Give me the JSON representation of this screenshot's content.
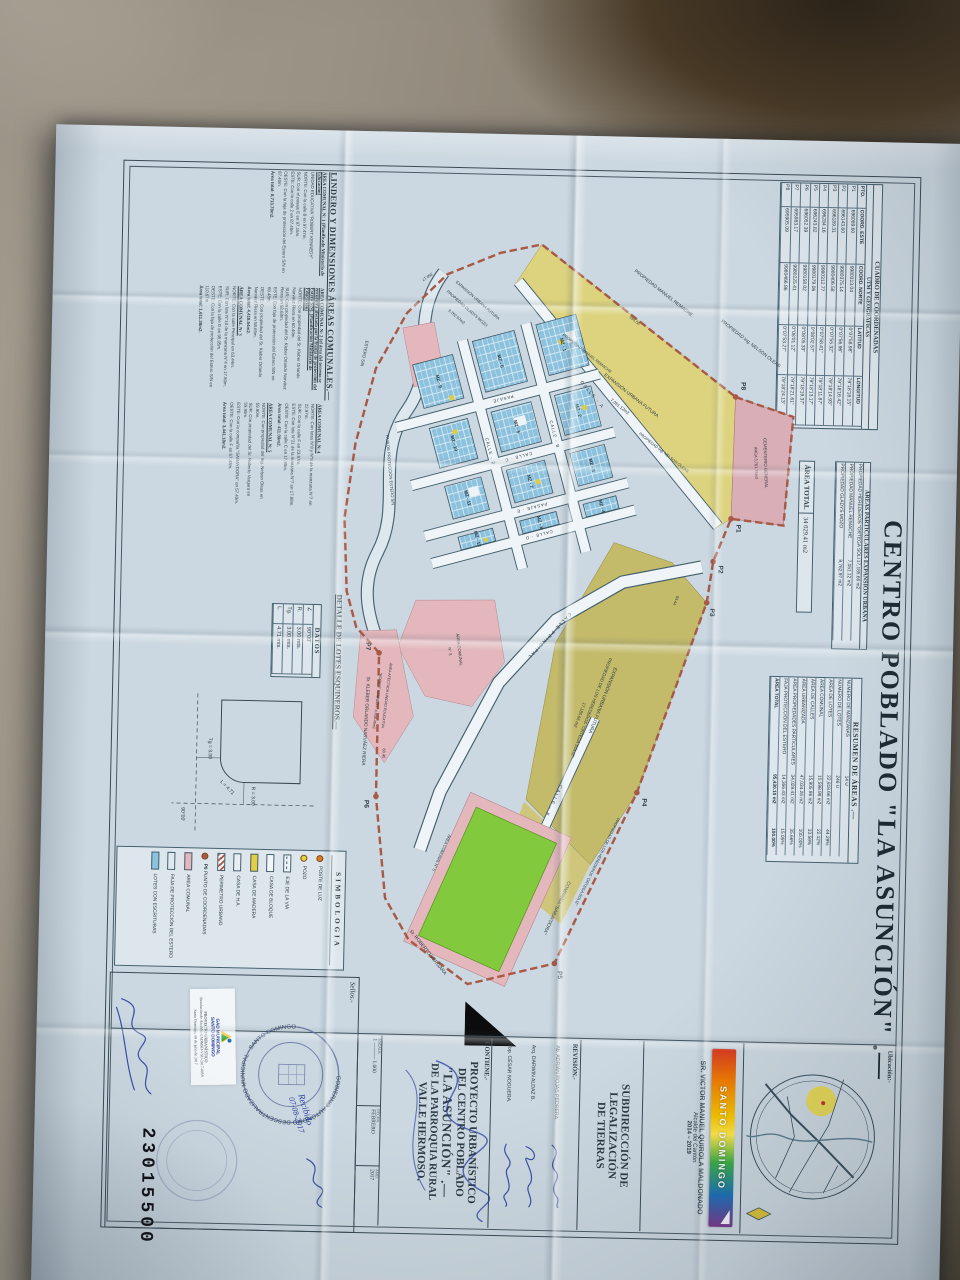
{
  "title": "CENTRO POBLADO \"LA ASUNCIÓN\" .—",
  "sheet_number": "23015500",
  "coord_table": {
    "title_line1": "CUADRO DE COORDENADAS",
    "title_line2": "UTM Y GEOGRÁFICAS",
    "headers": [
      "PTO.",
      "COORD. ESTE",
      "COORD. NORTE",
      "LATITUD",
      "LONGITUD"
    ],
    "rows": [
      [
        "P1",
        "696089.60",
        "9980313.04",
        "0°07'58.98\"",
        "79°18'18.15\""
      ],
      [
        "P2",
        "696143.60",
        "9980375.14",
        "0°07'56.96\"",
        "79°18'16.42\""
      ],
      [
        "P3",
        "696189.31",
        "9980406.58",
        "0°07'55.32\"",
        "79°18'14.93\""
      ],
      [
        "P4",
        "696284.16",
        "9980312.77",
        "0°07'58.41\"",
        "79°18'11.87\""
      ],
      [
        "P5",
        "696243.82",
        "9980179.06",
        "0°08'02.57\"",
        "79°18'13.17\""
      ],
      [
        "P6",
        "696052.39",
        "9980158.02",
        "0°08'05.33\"",
        "79°18'19.37\""
      ],
      [
        "P7",
        "695983.17",
        "9980225.41",
        "0°08'01.12\"",
        "79°18'21.61\""
      ],
      [
        "P8",
        "695905.09",
        "9980466.86",
        "0°07'53.27\"",
        "79°18'24.13\""
      ]
    ]
  },
  "areas_particulares": {
    "title": "ÁREAS PARTICULARES EXPANSIÓN URBANA",
    "rows": [
      {
        "label": "PROPIEDAD HEREDEROS \"ORTEGA SOLIZ\"",
        "value": "17,185.66 m2"
      },
      {
        "label": "PROPIEDAD MANUEL REMACHE",
        "value": "7,051.12 m2"
      },
      {
        "label": "PROPIEDAD GLADYS MOZO",
        "value": "9,762.97 m2"
      }
    ]
  },
  "area_total": {
    "label": "ÁREA TOTAL",
    "value": "34 029.41 m2"
  },
  "resumen": {
    "title": "RESUMEN DE ÁREAS .—",
    "rows": [
      [
        "NÚMERO DE MANZANAS",
        "14 U",
        ""
      ],
      [
        "NÚMERO DE LOTES",
        "246 U",
        ""
      ],
      [
        "ÁREA DE LOTES",
        "22,818.66 m2",
        "44.29%"
      ],
      [
        "ÁREA COMUNAL",
        "10,598.98 m2",
        "22.12%"
      ],
      [
        "ÁREA DE CALLES",
        "15,905.96 m2",
        "33.59%"
      ],
      [
        "ÁREA URBANIZADA",
        "47,034.26 m2",
        "100.00%"
      ],
      [
        "ÁREA PROPIEDADES PARTICULARES",
        "34,029.41 m2",
        "35.66%"
      ],
      [
        "FAJA PROTECCIÓN DEL ESTERO",
        "14,366.43 m2",
        "15.05%"
      ],
      [
        "ÁREA TOTAL",
        "95,430.10 m2",
        "100.00%"
      ]
    ]
  },
  "lindero": {
    "title": "LINDERO Y DIMENSIONES ÁREAS COMUNALES.—",
    "sections": [
      {
        "heading": "ÁREA COMUNAL N: 1 (Planificado Ministerio de Educación)",
        "lines": [
          "UNIDAD EDUCATIVA \"ROBERT KENNEDY\"",
          "NORTE: Con la calle B en 97.47m.",
          "SUR: Con el pasaje E en 97.15m.",
          "ESTE: Con la calle 2 en 87.40m.",
          "OESTE: Con la faja de protección del Estero S/N en 87.40m.",
          "Área total: 8,713.78m2."
        ]
      },
      {
        "heading": "ÁREA COMUNAL N: 2 (el área del terreno se encuentra afectada por la franja de protección del Estero S/N). (Planificación Ministerio de Educación)",
        "lines": [
          "NORTE: Con propiedad del Sr. Kleber Orlando Narváez Riera en 60.40m.",
          "SUR: Con propiedad del Sr. Kleber Orlando Narváez Riera en 92.68m.",
          "ESTE: Con faja de protección del Estero S/N en 69.48m.",
          "OESTE: Con propiedad del Sr. Kleber Orlando Narváez Riera en 58.65m.",
          "Área total: 4,418.54m2."
        ]
      },
      {
        "heading": "ÁREA COMUNAL N: 3",
        "lines": [
          "NORTE: Con la calle Principal en 63.44m.",
          "SUR: Con lote N°10 de la manzana N°4 en 17.80m.",
          "ESTE: Con la calle D en 95.05m.",
          "OESTE: Con la faja de protección del Estero S/N en 110.67m.",
          "Área total: 1,611.38m2."
        ]
      },
      {
        "heading": "ÁREA COMUNAL N: 4",
        "lines": [
          "NORTE: Con lotes N°8 y N°9 de la manzana N°7 en 22.97m.",
          "SUR: Con la calle F en 23.97m.",
          "ESTE: Con lote N°21 de la manzana N°7 en 17.88m.",
          "OESTE: Con la calle C en 17.88m.",
          "Área total: 411.09m2."
        ]
      },
      {
        "heading": "ÁREA COMUNAL N: 5",
        "lines": [
          "NORTE: Con propiedad del Ing. Nelson Oleas en 59.90m.",
          "SUR: Con propiedad del Sr. Roberto Vergara en 59.90m.",
          "ESTE: Con la compañía \"SARAYDORA\" en 57.43m.",
          "OESTE: Con la calle F en 57.43m.",
          "Área total: 3,441.18m2."
        ]
      }
    ]
  },
  "detalle": {
    "title": "DETALLE DE LOTES ESQUINEROS.—",
    "datos_title": "DATOS",
    "rows": [
      [
        "∠",
        "90°00'"
      ],
      [
        "R.",
        "3.00 mts."
      ],
      [
        "Tg.",
        "3.00 mts."
      ],
      [
        "L.",
        "4.71 mts."
      ]
    ],
    "diagram": {
      "r": "R = 3.00",
      "tg": "Tg = 3.00",
      "l": "L = 4.71",
      "ang": "90°00'"
    }
  },
  "simbologia": {
    "title": "SIMBOLOGIA",
    "items": [
      {
        "label": "POSTE DE LUZ"
      },
      {
        "label": "POZO"
      },
      {
        "label": "EJE DE LA VIA"
      },
      {
        "label": "CASA DE BLOQUE"
      },
      {
        "label": "CASA DE MADERA"
      },
      {
        "label": "CASA DE H.A."
      },
      {
        "label": "PERIMETRO URBANO"
      },
      {
        "label": "PUNTO DE COORDENADAS",
        "extra": "P0"
      },
      {
        "label": "AREA COMUNAL"
      },
      {
        "label": "FAJA DE PROTECCIÓN DEL ESTERO"
      },
      {
        "label": "LOTES CON ESCRITURAS"
      }
    ]
  },
  "map": {
    "streets": {
      "calle_a": "CALLE - A",
      "calle_b": "CALLE - B",
      "calle_2": "CALLE - 2",
      "calle_c": "CALLE - C",
      "pasaje": "PASAJE",
      "pasaje_e": "PASAJE - E",
      "calle_d": "CALLE - D",
      "calle_f": "CALLE - F",
      "calle_principal": "CALLE  PRINCIPAL"
    },
    "labels": {
      "cementerio": "CEMENTERIO GENERAL",
      "cementerio_area": "ÁREA 3,761.75m2",
      "expansion": "EXPANSIÓN URBANA FUTURA",
      "expansion_area": "7,051.12m2",
      "prop_remache": "PROPIEDAD MANUEL REMACHE",
      "prop_oleas": "PROPIEDAD Ing. NELSON OLEAS",
      "ortega_title": "EXPANSIÓN URBANA FUTURA",
      "ortega_sub": "PROPIEDAD DE LOS HEREDEROS \"ORTEGA SOLIZ\"",
      "ortega_area": "17,185.66 m2",
      "gladys_title": "EXPANSIÓN URBANA FUTURA",
      "gladys_sub": "PROPIEDAD GLADYS MOZO",
      "gladys_area": "9,762.97m2",
      "faja": "FAJA DE PROTECCIÓN ESTERO S/N",
      "estero": "ESTERO S/N",
      "kleber": "Sr. KLEBER ORLANDO NARVÁEZ RIERA",
      "roberto": "Sr. ROBERTO VERGARA",
      "compania": "COMPAÑÍA \"SARAYDORA\"",
      "escuela1": "ÁREA AFECTADA UNIDAD EDUCATIVA",
      "escuela2": "\"ROBERT KENNEDY\"  4,438.49m2",
      "area_comunal3a": "ÁREA COMUNAL",
      "area_comunal3b": "N° 3",
      "area_comunal5": "ÁREA COMUNAL N° 5",
      "dim1": "358.17",
      "dim2": "591.56",
      "dim3": "63.44",
      "dim4": "60.40"
    },
    "manzanas": [
      "MZ - 1",
      "MZ - 2",
      "MZ - 3",
      "MZ - 4",
      "MZ - 6",
      "MZ - 5",
      "MZ - 7",
      "MZ - 8",
      "MZ - 9",
      "MZ - 10",
      "MZ - 11",
      "MZ - 12"
    ],
    "points": [
      "P1",
      "P2",
      "P3",
      "P4",
      "P5",
      "P6",
      "P7",
      "P8"
    ]
  },
  "ubicacion": {
    "label": "Ubicación:-"
  },
  "titleblock": {
    "brand": "SANTO DOMINGO",
    "mayor_name": "SR. VICTOR MANUEL QUIROLA MALDONADO",
    "mayor_role": "Alcalde del Cantón",
    "mayor_period": "2014 – 2019",
    "department1": "SUBDIRECCIÓN DE LEGALIZACIÓN",
    "department2": "DE TIERRAS",
    "revision_label": "REVISIÓN.-",
    "revisers": [
      "Ab. ADRIÁN ROJAS PEDRERA.",
      "Arq. DARWIN ALDAZ B.",
      "Top. CÉSAR NOGUERA."
    ],
    "contains_label": "CONTIENE.-",
    "project1": "PROYECTO URBANÍSTICO",
    "project2": "DEL CENTRO POBLADO",
    "project3": "\"LA ASUNCIÓN\" .—",
    "project4": "DE LA PARROQUIA RURAL",
    "project5": "VALLE HERMOSO.",
    "scale_label": "ESCALA:",
    "scale_value": "1 ——— 1.000",
    "date_label": "FECHA:",
    "date_value": "FEBRERO",
    "year_label": "AÑO:",
    "year_value": "2017",
    "seals_label": "Sellos.-"
  },
  "seals": {
    "stamp_text": "GOBIERNO AUTÓNOMO DESCENTRALIZADO MUNICIPAL · SANTO DOMINGO ·",
    "received_note": "Recibido",
    "received_date": "07-08-2017",
    "gad_name1": "GAD MUNICIPAL",
    "gad_name2": "SANTO DOMINGO",
    "gad_line1": "PROYECTO URBANÍSTICO",
    "gad_line2": "Resolución de Alcaldía GADMSD-VSU-2017-0059",
    "gad_line3": "Santo Domingo, 06 de julio de 2017"
  }
}
